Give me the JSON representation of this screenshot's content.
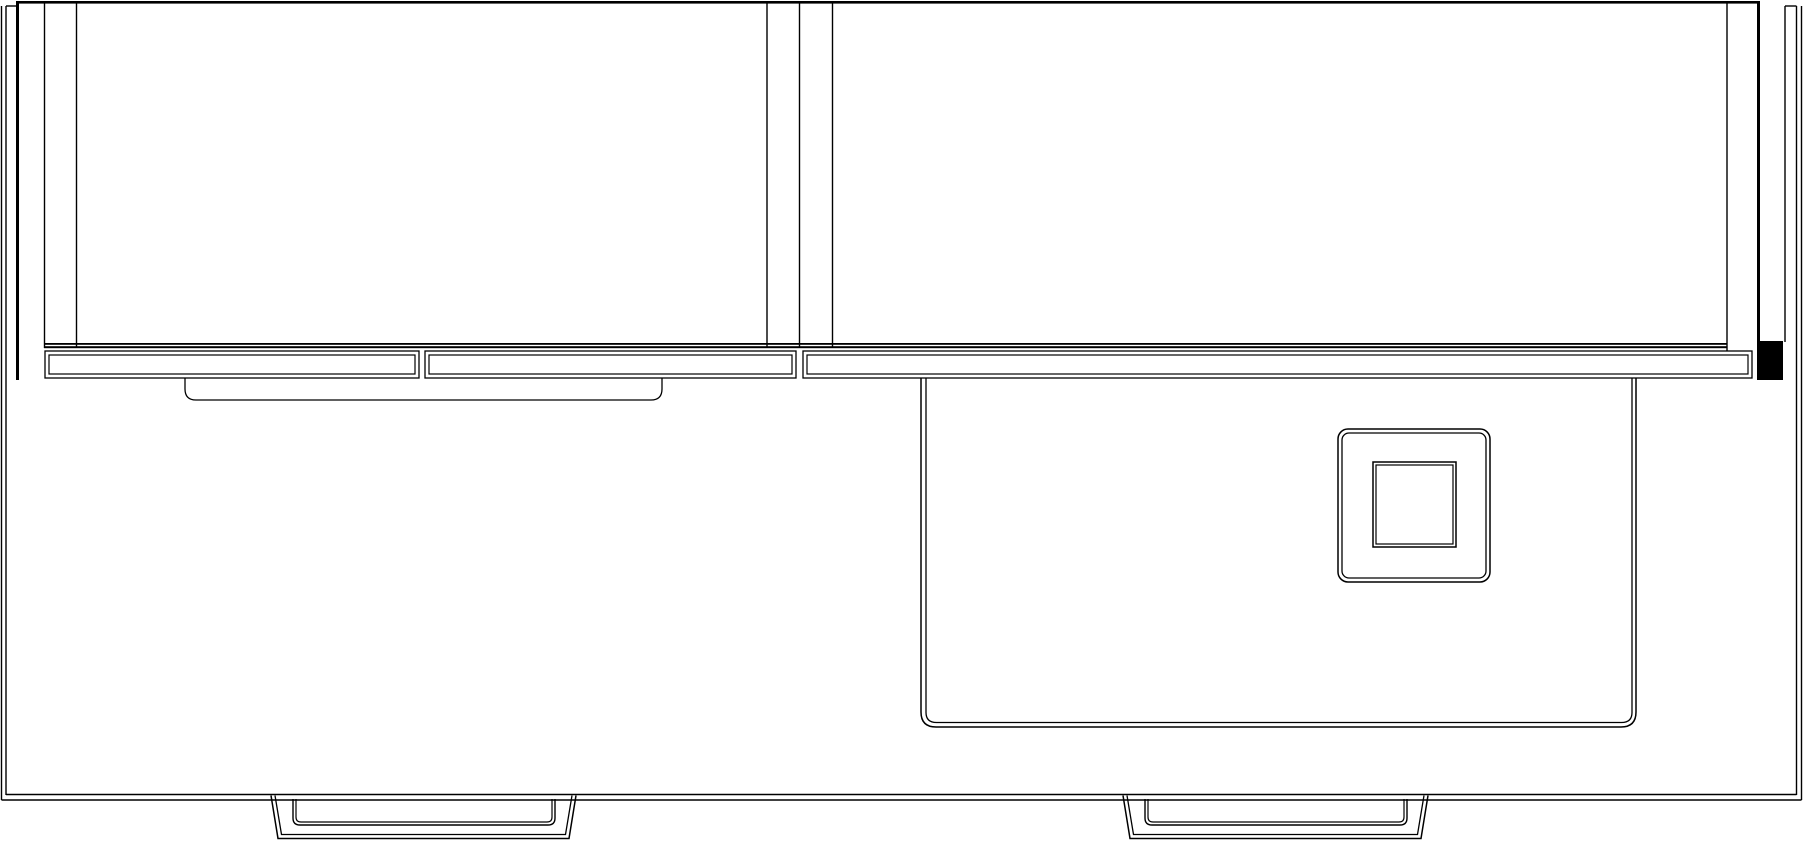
{
  "canvas": {
    "width": 1803,
    "height": 842,
    "background_color": "#ffffff",
    "line_color": "#000000"
  },
  "drawing": {
    "kind": "cad-line-drawing-elevation",
    "shapes": [
      {
        "name": "cabinet-top-edge",
        "kind": "rect",
        "x": 17,
        "y": 1,
        "width": 1742,
        "height": 2.6,
        "fill": "black"
      },
      {
        "name": "left-side-panel-edge",
        "kind": "rect",
        "x": 16,
        "y": 1,
        "width": 3,
        "height": 379,
        "fill": "black"
      },
      {
        "name": "right-side-panel-edge",
        "kind": "rect",
        "x": 1757,
        "y": 1,
        "width": 3,
        "height": 342,
        "fill": "black"
      },
      {
        "name": "right-side-panel-end-cap",
        "kind": "rect",
        "x": 1757,
        "y": 341,
        "width": 26,
        "height": 39,
        "fill": "black"
      },
      {
        "name": "left-stile-line-a",
        "kind": "line",
        "x1": 44.5,
        "y1": 2,
        "x2": 44.5,
        "y2": 348,
        "w": 1.4
      },
      {
        "name": "left-stile-line-b",
        "kind": "line",
        "x1": 76.5,
        "y1": 2,
        "x2": 76.5,
        "y2": 348,
        "w": 1.4
      },
      {
        "name": "center-stile-line-a",
        "kind": "line",
        "x1": 767,
        "y1": 2,
        "x2": 767,
        "y2": 348,
        "w": 1.4
      },
      {
        "name": "center-stile-line-b",
        "kind": "line",
        "x1": 799.5,
        "y1": 2,
        "x2": 799.5,
        "y2": 348,
        "w": 1.4
      },
      {
        "name": "center-stile-line-c",
        "kind": "line",
        "x1": 832.5,
        "y1": 2,
        "x2": 832.5,
        "y2": 348,
        "w": 1.4
      },
      {
        "name": "right-stile-line-a",
        "kind": "line",
        "x1": 1727,
        "y1": 2,
        "x2": 1727,
        "y2": 351,
        "w": 1.4
      },
      {
        "name": "right-stile-line-b",
        "kind": "line",
        "x1": 1785,
        "y1": 6,
        "x2": 1785,
        "y2": 342,
        "w": 1.4
      },
      {
        "name": "frame-left-outer-edge",
        "kind": "line",
        "x1": 1.5,
        "y1": 6,
        "x2": 1.5,
        "y2": 800,
        "w": 1.4
      },
      {
        "name": "frame-left-inner-edge",
        "kind": "line",
        "x1": 6,
        "y1": 6,
        "x2": 6,
        "y2": 795,
        "w": 1.4
      },
      {
        "name": "frame-right-inner-edge",
        "kind": "line",
        "x1": 1796.5,
        "y1": 6,
        "x2": 1796.5,
        "y2": 795,
        "w": 1.4
      },
      {
        "name": "frame-right-outer-edge",
        "kind": "line",
        "x1": 1801.5,
        "y1": 6,
        "x2": 1801.5,
        "y2": 800,
        "w": 1.4
      },
      {
        "name": "frame-bottom-inner-edge",
        "kind": "line",
        "x1": 6,
        "y1": 794.5,
        "x2": 1796.5,
        "y2": 794.5,
        "w": 1.4
      },
      {
        "name": "frame-bottom-outer-edge",
        "kind": "line",
        "x1": 1.5,
        "y1": 800,
        "x2": 1801.5,
        "y2": 800,
        "w": 1.4
      },
      {
        "name": "frame-top-cap-left",
        "kind": "line",
        "x1": 6,
        "y1": 6,
        "x2": 19,
        "y2": 6,
        "w": 1.4
      },
      {
        "name": "frame-top-cap-right",
        "kind": "line",
        "x1": 1785,
        "y1": 6,
        "x2": 1796.5,
        "y2": 6,
        "w": 1.4
      },
      {
        "name": "rail-top-line-upper",
        "kind": "rect",
        "x": 44,
        "y": 343,
        "width": 1683,
        "height": 1.8,
        "fill": "black"
      },
      {
        "name": "rail-top-line-lower",
        "kind": "rect",
        "x": 44,
        "y": 346.2,
        "width": 1683,
        "height": 2,
        "fill": "black"
      },
      {
        "name": "drawer-front-1-outer",
        "kind": "rect",
        "x": 45,
        "y": 351,
        "width": 374,
        "height": 27,
        "w": 1.3
      },
      {
        "name": "drawer-front-1-inner",
        "kind": "rect",
        "x": 49,
        "y": 355,
        "width": 366,
        "height": 19,
        "w": 1.2
      },
      {
        "name": "drawer-front-2-outer",
        "kind": "rect",
        "x": 425,
        "y": 351,
        "width": 371,
        "height": 27,
        "w": 1.3
      },
      {
        "name": "drawer-front-2-inner",
        "kind": "rect",
        "x": 429,
        "y": 355,
        "width": 363,
        "height": 19,
        "w": 1.2
      },
      {
        "name": "drawer-front-3-outer",
        "kind": "rect",
        "x": 803,
        "y": 351,
        "width": 949,
        "height": 27,
        "w": 1.3
      },
      {
        "name": "drawer-front-3-inner",
        "kind": "rect",
        "x": 807,
        "y": 355,
        "width": 941,
        "height": 19,
        "w": 1.2
      },
      {
        "name": "handle-tray-outline",
        "kind": "path",
        "d": "M185,378 L185,389 Q185,400 196,400 L651,400 Q662,400 662,389 L662,378",
        "w": 1.3
      },
      {
        "name": "basin-outline-outer",
        "kind": "path",
        "d": "M921,378 L921,712 Q921,727 936,727 L1621,727 Q1636,727 1636,712 L1636,378",
        "w": 1.5
      },
      {
        "name": "basin-outline-inner",
        "kind": "path",
        "d": "M926,378 L926,712.5 Q926,722.5 936.5,722.5 L1621.5,722.5 Q1632,722.5 1632,712.5 L1632,378",
        "w": 1.3
      },
      {
        "name": "drain-plate-outer",
        "kind": "rect",
        "x": 1338,
        "y": 429,
        "width": 152,
        "height": 153,
        "rx": 10,
        "w": 1.5
      },
      {
        "name": "drain-plate-inner",
        "kind": "rect",
        "x": 1342,
        "y": 433,
        "width": 144,
        "height": 145,
        "rx": 7,
        "w": 1.3
      },
      {
        "name": "drain-square-outer",
        "kind": "rect",
        "x": 1373,
        "y": 462,
        "width": 83,
        "height": 85,
        "w": 1.5
      },
      {
        "name": "drain-square-inner",
        "kind": "rect",
        "x": 1376,
        "y": 465,
        "width": 77,
        "height": 79,
        "w": 1.2
      },
      {
        "name": "left-foot-bracket-outer",
        "kind": "path",
        "d": "M271,795.5 L278,838.5 L569,838.5 L576,795.5",
        "w": 1.5
      },
      {
        "name": "left-foot-bracket-inner",
        "kind": "path",
        "d": "M275,795.5 L281.5,834.5 L565.5,834.5 L572,795.5",
        "w": 1.3
      },
      {
        "name": "left-foot-pad-outer",
        "kind": "path",
        "d": "M293,799 L293,818 Q293,825 300,825 L548,825 Q555,825 555,818 L555,799",
        "w": 1.4
      },
      {
        "name": "left-foot-pad-inner",
        "kind": "path",
        "d": "M296,799 L296,817 Q296,822 301,822 L547,822 Q552,822 552,817 L552,799",
        "w": 1.2
      },
      {
        "name": "right-foot-bracket-outer",
        "kind": "path",
        "d": "M1123,795.5 L1130,838.5 L1421,838.5 L1428,795.5",
        "w": 1.5
      },
      {
        "name": "right-foot-bracket-inner",
        "kind": "path",
        "d": "M1127,795.5 L1133.5,834.5 L1417.5,834.5 L1424,795.5",
        "w": 1.3
      },
      {
        "name": "right-foot-pad-outer",
        "kind": "path",
        "d": "M1145,799 L1145,818 Q1145,825 1152,825 L1400,825 Q1407,825 1407,818 L1407,799",
        "w": 1.4
      },
      {
        "name": "right-foot-pad-inner",
        "kind": "path",
        "d": "M1148,799 L1148,817 Q1148,822 1153,822 L1399,822 Q1404,822 1404,817 L1404,799",
        "w": 1.2
      }
    ]
  }
}
